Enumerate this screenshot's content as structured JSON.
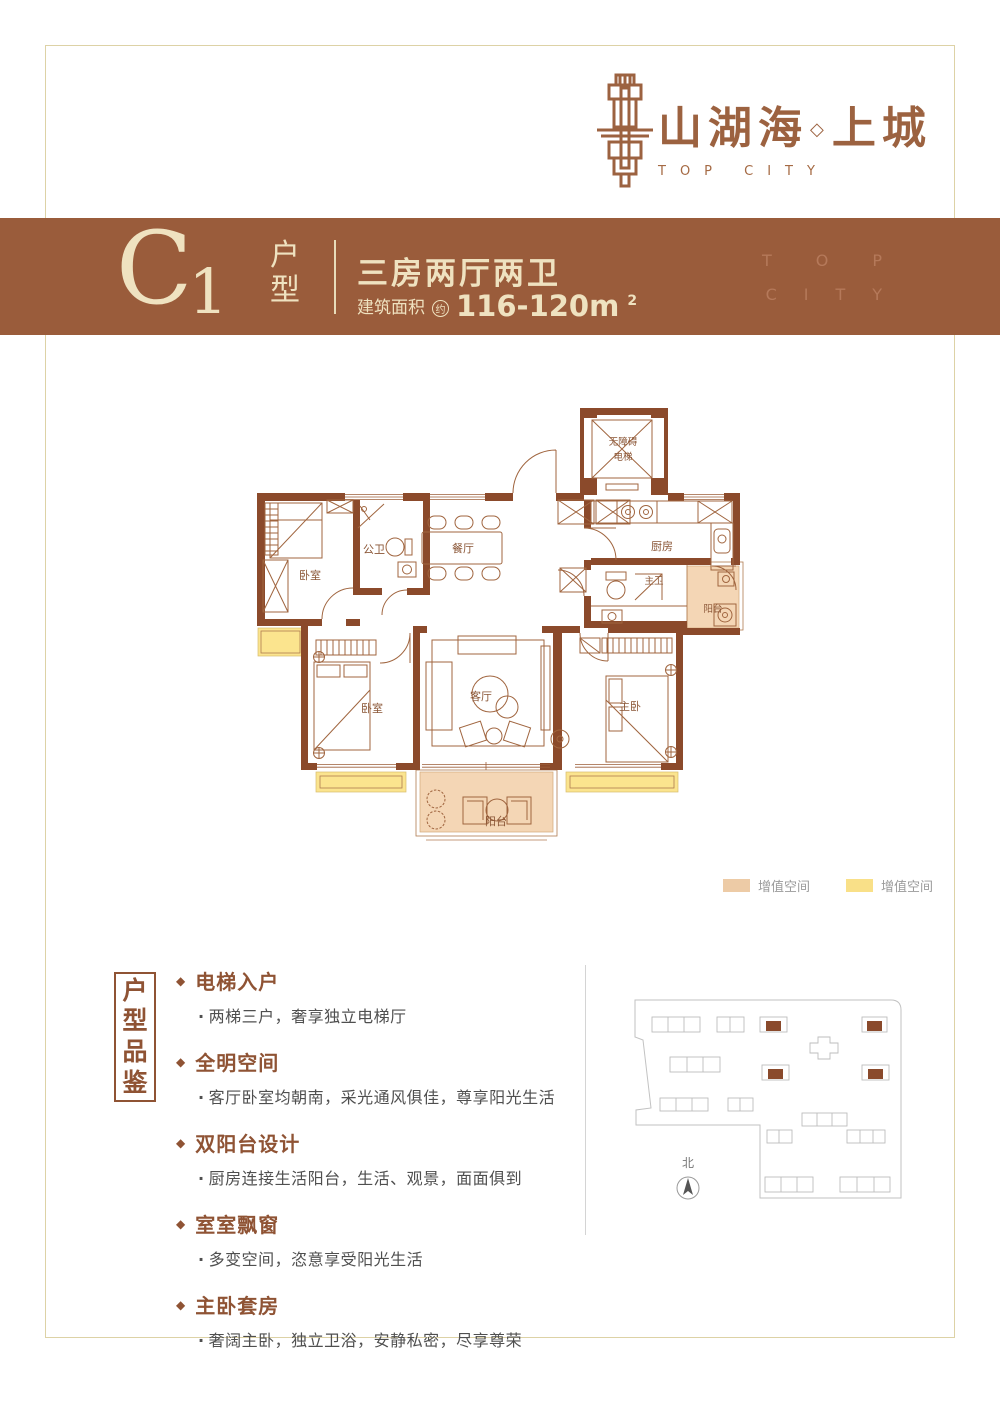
{
  "colors": {
    "banner_bg": "#9a5c3b",
    "banner_text": "#efe2c0",
    "accent_brown": "#8f5334",
    "wall_brown": "#8b4a2b",
    "furniture_line": "#a0653f",
    "highlight_orange": "#f4d6b5",
    "highlight_yellow": "#fbe48e",
    "watermark": "#b5795a",
    "page_border": "#ddd2a6"
  },
  "logo": {
    "cn": "山湖海",
    "separator": "◇",
    "cn2": "上城",
    "en": "TOP CITY"
  },
  "banner": {
    "code_letter": "C",
    "code_number": "1",
    "type_chars": [
      "户",
      "型"
    ],
    "headline": "三房两厅两卫",
    "area_label": "建筑面积",
    "area_circle": "约",
    "area_value": "116-120m",
    "area_exp": "2",
    "wm1": "TOP",
    "wm2": "CITY"
  },
  "floorplan": {
    "elevator_line1": "无障碍",
    "elevator_line2": "电梯",
    "bedroom_top": "卧室",
    "guest_bath": "公卫",
    "dining": "餐厅",
    "kitchen": "厨房",
    "master_bath": "主卫",
    "balcony_side": "阳台",
    "bedroom_left": "卧室",
    "living": "客厅",
    "master": "主卧",
    "balcony_bottom": "阳台"
  },
  "legend": {
    "items": [
      {
        "label": "增值空间",
        "color": "#edcba6"
      },
      {
        "label": "增值空间",
        "color": "#f9e088"
      }
    ]
  },
  "features": {
    "box_chars": [
      "户",
      "型",
      "品",
      "鉴"
    ],
    "marker": "◆",
    "dot": "·",
    "items": [
      {
        "title": "电梯入户",
        "desc": "两梯三户，奢享独立电梯厅"
      },
      {
        "title": "全明空间",
        "desc": "客厅卧室均朝南，采光通风俱佳，尊享阳光生活"
      },
      {
        "title": "双阳台设计",
        "desc": "厨房连接生活阳台，生活、观景，面面俱到"
      },
      {
        "title": "室室飘窗",
        "desc": "多变空间，恣意享受阳光生活"
      },
      {
        "title": "主卧套房",
        "desc": "奢阔主卧，独立卫浴，安静私密，尽享尊荣"
      }
    ]
  },
  "sitemap": {
    "north": "北"
  }
}
